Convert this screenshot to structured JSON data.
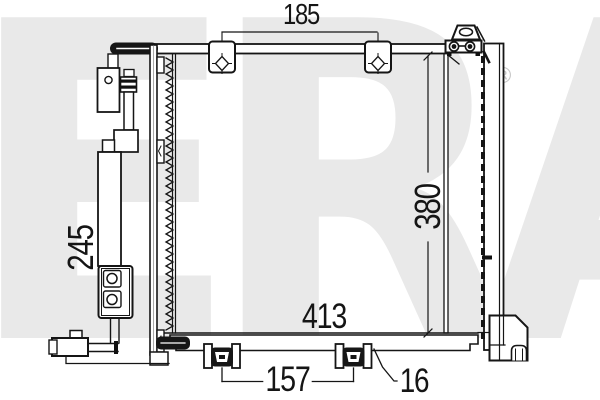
{
  "watermark": {
    "text": "ERA",
    "registered_symbol": "®"
  },
  "drawing": {
    "type": "technical-part-drawing",
    "part": "air-conditioning condenser",
    "dimensions": {
      "top_mount_spacing": "185",
      "left_drier_height": "245",
      "core_height": "380",
      "overall_width": "413",
      "feet_spacing": "157",
      "foot_detail": "16"
    },
    "line_color": "#151515",
    "watermark_color": "#e9e9e9"
  }
}
